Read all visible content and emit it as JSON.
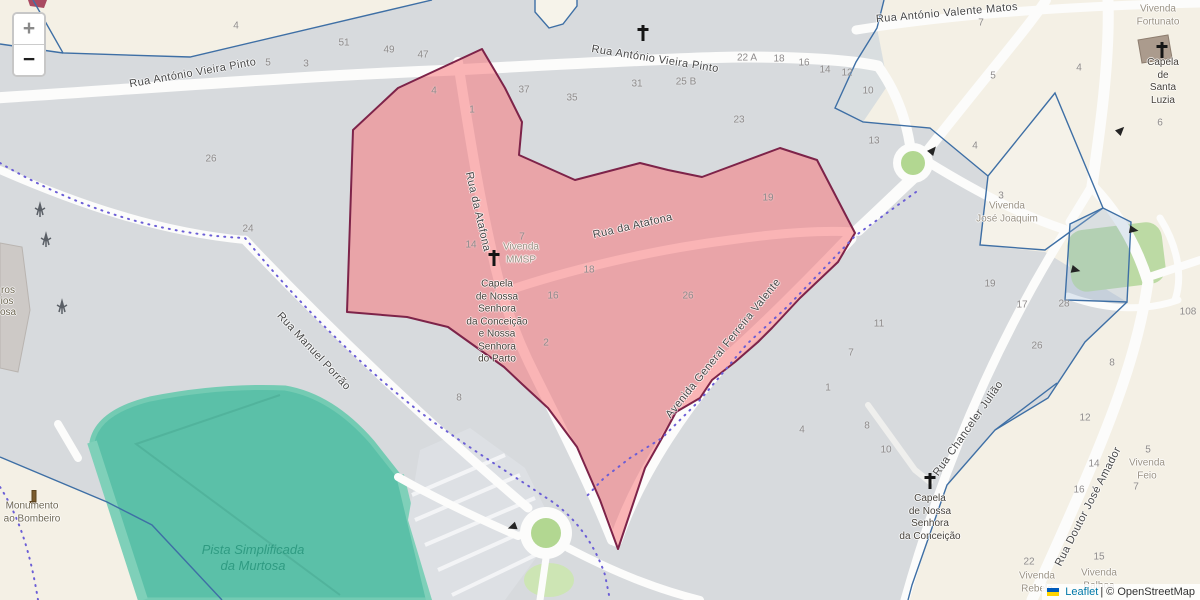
{
  "map": {
    "controls": {
      "zoom_in": "+",
      "zoom_out": "−"
    },
    "attribution": {
      "leaflet": "Leaflet",
      "separator": "|",
      "osm": "© OpenStreetMap"
    },
    "streets": {
      "vieira_pinto": "Rua António Vieira Pinto",
      "valente_matos": "Rua António Valente Matos",
      "atafona": "Rua da Atafona",
      "avenida": "Avenida General Ferreira Valente",
      "manuel_porrao": "Rua Manuel Porrão",
      "chanceler": "Rua Chanceler Julião",
      "doutor_amador": "Rua Doutor José Amador"
    },
    "places": {
      "vivenda_fortunato": "Vivenda\nFortunato",
      "capela_santa_luzia": "Capela\nde Santa\nLuzia",
      "vivenda_jose_joaquim": "Vivenda\nJosé Joaquim",
      "vivenda_mmsp": "Vivenda\nMMSP",
      "capela_parto": "Capela\nde Nossa\nSenhora\nda Conceição\ne Nossa\nSenhora\ndo Parto",
      "capela_conceicao": "Capela\nde Nossa\nSenhora\nda Conceição",
      "monumento": "Monumento\nao Bombeiro",
      "pista": "Pista Simplificada\nda Murtosa",
      "vivenda_feio": "Vivenda\nFeio",
      "vivenda_rebelo": "Vivenda\nRebelo",
      "vivenda_balboa": "Vivenda\nBalboa"
    },
    "partial_left": [
      "ros",
      "ios",
      "osa"
    ],
    "house_numbers": [
      {
        "label": "4",
        "x": 236,
        "y": 26
      },
      {
        "label": "51",
        "x": 344,
        "y": 43
      },
      {
        "label": "49",
        "x": 389,
        "y": 50
      },
      {
        "label": "47",
        "x": 423,
        "y": 55
      },
      {
        "label": "5",
        "x": 268,
        "y": 63
      },
      {
        "label": "3",
        "x": 306,
        "y": 64
      },
      {
        "label": "26",
        "x": 211,
        "y": 159
      },
      {
        "label": "24",
        "x": 248,
        "y": 229
      },
      {
        "label": "4",
        "x": 434,
        "y": 91
      },
      {
        "label": "1",
        "x": 472,
        "y": 110
      },
      {
        "label": "37",
        "x": 524,
        "y": 90
      },
      {
        "label": "35",
        "x": 572,
        "y": 98
      },
      {
        "label": "31",
        "x": 637,
        "y": 84
      },
      {
        "label": "25 B",
        "x": 686,
        "y": 82
      },
      {
        "label": "22 A",
        "x": 747,
        "y": 58
      },
      {
        "label": "18",
        "x": 779,
        "y": 59
      },
      {
        "label": "16",
        "x": 804,
        "y": 63
      },
      {
        "label": "14",
        "x": 825,
        "y": 70
      },
      {
        "label": "12",
        "x": 847,
        "y": 73
      },
      {
        "label": "10",
        "x": 868,
        "y": 91
      },
      {
        "label": "23",
        "x": 739,
        "y": 120
      },
      {
        "label": "19",
        "x": 768,
        "y": 198
      },
      {
        "label": "13",
        "x": 874,
        "y": 141
      },
      {
        "label": "7",
        "x": 981,
        "y": 23
      },
      {
        "label": "5",
        "x": 993,
        "y": 76
      },
      {
        "label": "4",
        "x": 1079,
        "y": 68
      },
      {
        "label": "4",
        "x": 975,
        "y": 146
      },
      {
        "label": "3",
        "x": 1001,
        "y": 196
      },
      {
        "label": "6",
        "x": 1160,
        "y": 123
      },
      {
        "label": "14",
        "x": 471,
        "y": 245
      },
      {
        "label": "7",
        "x": 522,
        "y": 237
      },
      {
        "label": "18",
        "x": 589,
        "y": 270
      },
      {
        "label": "16",
        "x": 553,
        "y": 296
      },
      {
        "label": "26",
        "x": 688,
        "y": 296
      },
      {
        "label": "2",
        "x": 546,
        "y": 343
      },
      {
        "label": "8",
        "x": 459,
        "y": 398
      },
      {
        "label": "19",
        "x": 990,
        "y": 284
      },
      {
        "label": "17",
        "x": 1022,
        "y": 305
      },
      {
        "label": "28",
        "x": 1064,
        "y": 304
      },
      {
        "label": "26",
        "x": 1037,
        "y": 346
      },
      {
        "label": "8",
        "x": 1112,
        "y": 363
      },
      {
        "label": "108",
        "x": 1188,
        "y": 312
      },
      {
        "label": "11",
        "x": 879,
        "y": 324
      },
      {
        "label": "7",
        "x": 851,
        "y": 353
      },
      {
        "label": "1",
        "x": 828,
        "y": 388
      },
      {
        "label": "4",
        "x": 802,
        "y": 430
      },
      {
        "label": "8",
        "x": 867,
        "y": 426
      },
      {
        "label": "10",
        "x": 886,
        "y": 450
      },
      {
        "label": "12",
        "x": 1085,
        "y": 418
      },
      {
        "label": "14",
        "x": 1094,
        "y": 464
      },
      {
        "label": "16",
        "x": 1079,
        "y": 490
      },
      {
        "label": "5",
        "x": 1148,
        "y": 450
      },
      {
        "label": "7",
        "x": 1136,
        "y": 487
      },
      {
        "label": "22",
        "x": 1029,
        "y": 562
      },
      {
        "label": "15",
        "x": 1099,
        "y": 557
      }
    ],
    "colors": {
      "highlight_fill": "#F2A9A9",
      "highlight_border": "#7D2349",
      "boundary_blue": "#3E6FA5",
      "admin_purple": "#6B5ED6",
      "track_teal": "#5BC0A8",
      "park_green": "#BCDAA4",
      "base_gray": "#D7DADD",
      "farmland_beige": "#F4F0E5",
      "leaflet_link": "#0078A8"
    }
  }
}
